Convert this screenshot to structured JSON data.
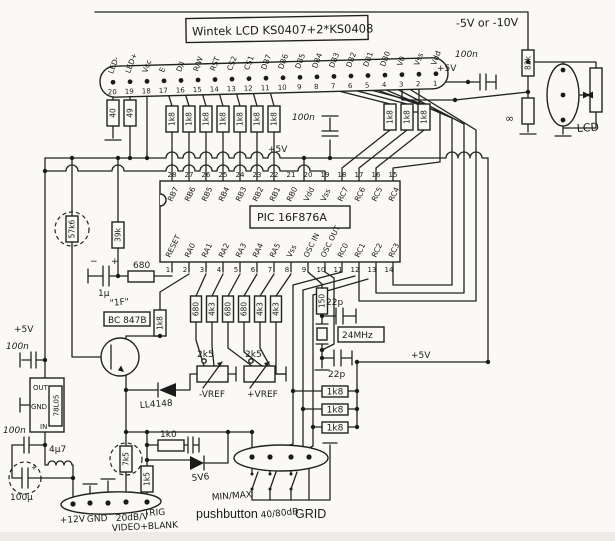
{
  "lcd": {
    "title": "Wintek LCD KS0407+2*KS0408",
    "pins": [
      {
        "n": "20",
        "label": "LED-"
      },
      {
        "n": "19",
        "label": "LED+"
      },
      {
        "n": "18",
        "label": "Vcc"
      },
      {
        "n": "17",
        "label": "E"
      },
      {
        "n": "16",
        "label": "D/I"
      },
      {
        "n": "15",
        "label": "R/W"
      },
      {
        "n": "14",
        "label": "RST"
      },
      {
        "n": "13",
        "label": "CS2"
      },
      {
        "n": "12",
        "label": "CS1"
      },
      {
        "n": "11",
        "label": "DB7"
      },
      {
        "n": "10",
        "label": "DB6"
      },
      {
        "n": "9",
        "label": "DB5"
      },
      {
        "n": "8",
        "label": "DB4"
      },
      {
        "n": "7",
        "label": "DB3"
      },
      {
        "n": "6",
        "label": "DB2"
      },
      {
        "n": "5",
        "label": "DB1"
      },
      {
        "n": "4",
        "label": "DB0"
      },
      {
        "n": "3",
        "label": "V0"
      },
      {
        "n": "2",
        "label": "Vss"
      },
      {
        "n": "1",
        "label": "Vdd"
      }
    ]
  },
  "pic": {
    "name": "PIC 16F876A",
    "top_pins": [
      {
        "n": "28",
        "label": "RB7"
      },
      {
        "n": "27",
        "label": "RB6"
      },
      {
        "n": "26",
        "label": "RB5"
      },
      {
        "n": "25",
        "label": "RB4"
      },
      {
        "n": "24",
        "label": "RB3"
      },
      {
        "n": "23",
        "label": "RB2"
      },
      {
        "n": "22",
        "label": "RB1"
      },
      {
        "n": "21",
        "label": "RB0"
      },
      {
        "n": "20",
        "label": "Vdd"
      },
      {
        "n": "19",
        "label": "Vss"
      },
      {
        "n": "18",
        "label": "RC7"
      },
      {
        "n": "17",
        "label": "RC6"
      },
      {
        "n": "16",
        "label": "RC5"
      },
      {
        "n": "15",
        "label": "RC4"
      }
    ],
    "bottom_pins": [
      {
        "n": "1",
        "label": "RESET"
      },
      {
        "n": "2",
        "label": "RA0"
      },
      {
        "n": "3",
        "label": "RA1"
      },
      {
        "n": "4",
        "label": "RA2"
      },
      {
        "n": "5",
        "label": "RA3"
      },
      {
        "n": "6",
        "label": "RA4"
      },
      {
        "n": "7",
        "label": "RA5"
      },
      {
        "n": "8",
        "label": "Vss"
      },
      {
        "n": "9",
        "label": "OSC IN"
      },
      {
        "n": "10",
        "label": "OSC OUT"
      },
      {
        "n": "11",
        "label": "RC0"
      },
      {
        "n": "12",
        "label": "RC1"
      },
      {
        "n": "13",
        "label": "RC2"
      },
      {
        "n": "14",
        "label": "RC3"
      }
    ]
  },
  "labels": {
    "neg_supply": "-5V or -10V",
    "plus5v": "+5V",
    "c100n": "100n",
    "r82k": "82k",
    "r_inf": "∞",
    "lcd_pot": "LCD",
    "r_led1": "40",
    "r_led2": "49",
    "r1k8": "1k8",
    "r57k6": "57k6",
    "r39k": "39k",
    "c1u": "1µ",
    "plus": "+",
    "minus": "−",
    "r680": "680",
    "note_1f": "\"1F\"",
    "bc847b": "BC 847B",
    "ll4148": "LL4148",
    "row": [
      "680",
      "4k3",
      "680",
      "680",
      "4k3",
      "4k3"
    ],
    "r2k5": "2k5",
    "vref_neg": "-VREF",
    "vref_pos": "+VREF",
    "r150": "150",
    "xtal": "24MHz",
    "c22p": "22p",
    "btn_minmax": "MIN/MAX",
    "btn_push": "pushbutton",
    "btn_40_80": "40/80dB",
    "btn_grid": "GRID",
    "reg_out": "OUT",
    "reg_gnd": "GND",
    "reg_in": "IN",
    "reg_name": "78L05",
    "c100u": "100µ",
    "l4u7": "4µ7",
    "r7k5": "7k5",
    "r1k5": "1k5",
    "r1k0": "1k0",
    "zener": "5V6",
    "conn": [
      "+12V",
      "GND",
      "20dB/V",
      "TRIG"
    ],
    "video": "VIDEO+BLANK"
  }
}
